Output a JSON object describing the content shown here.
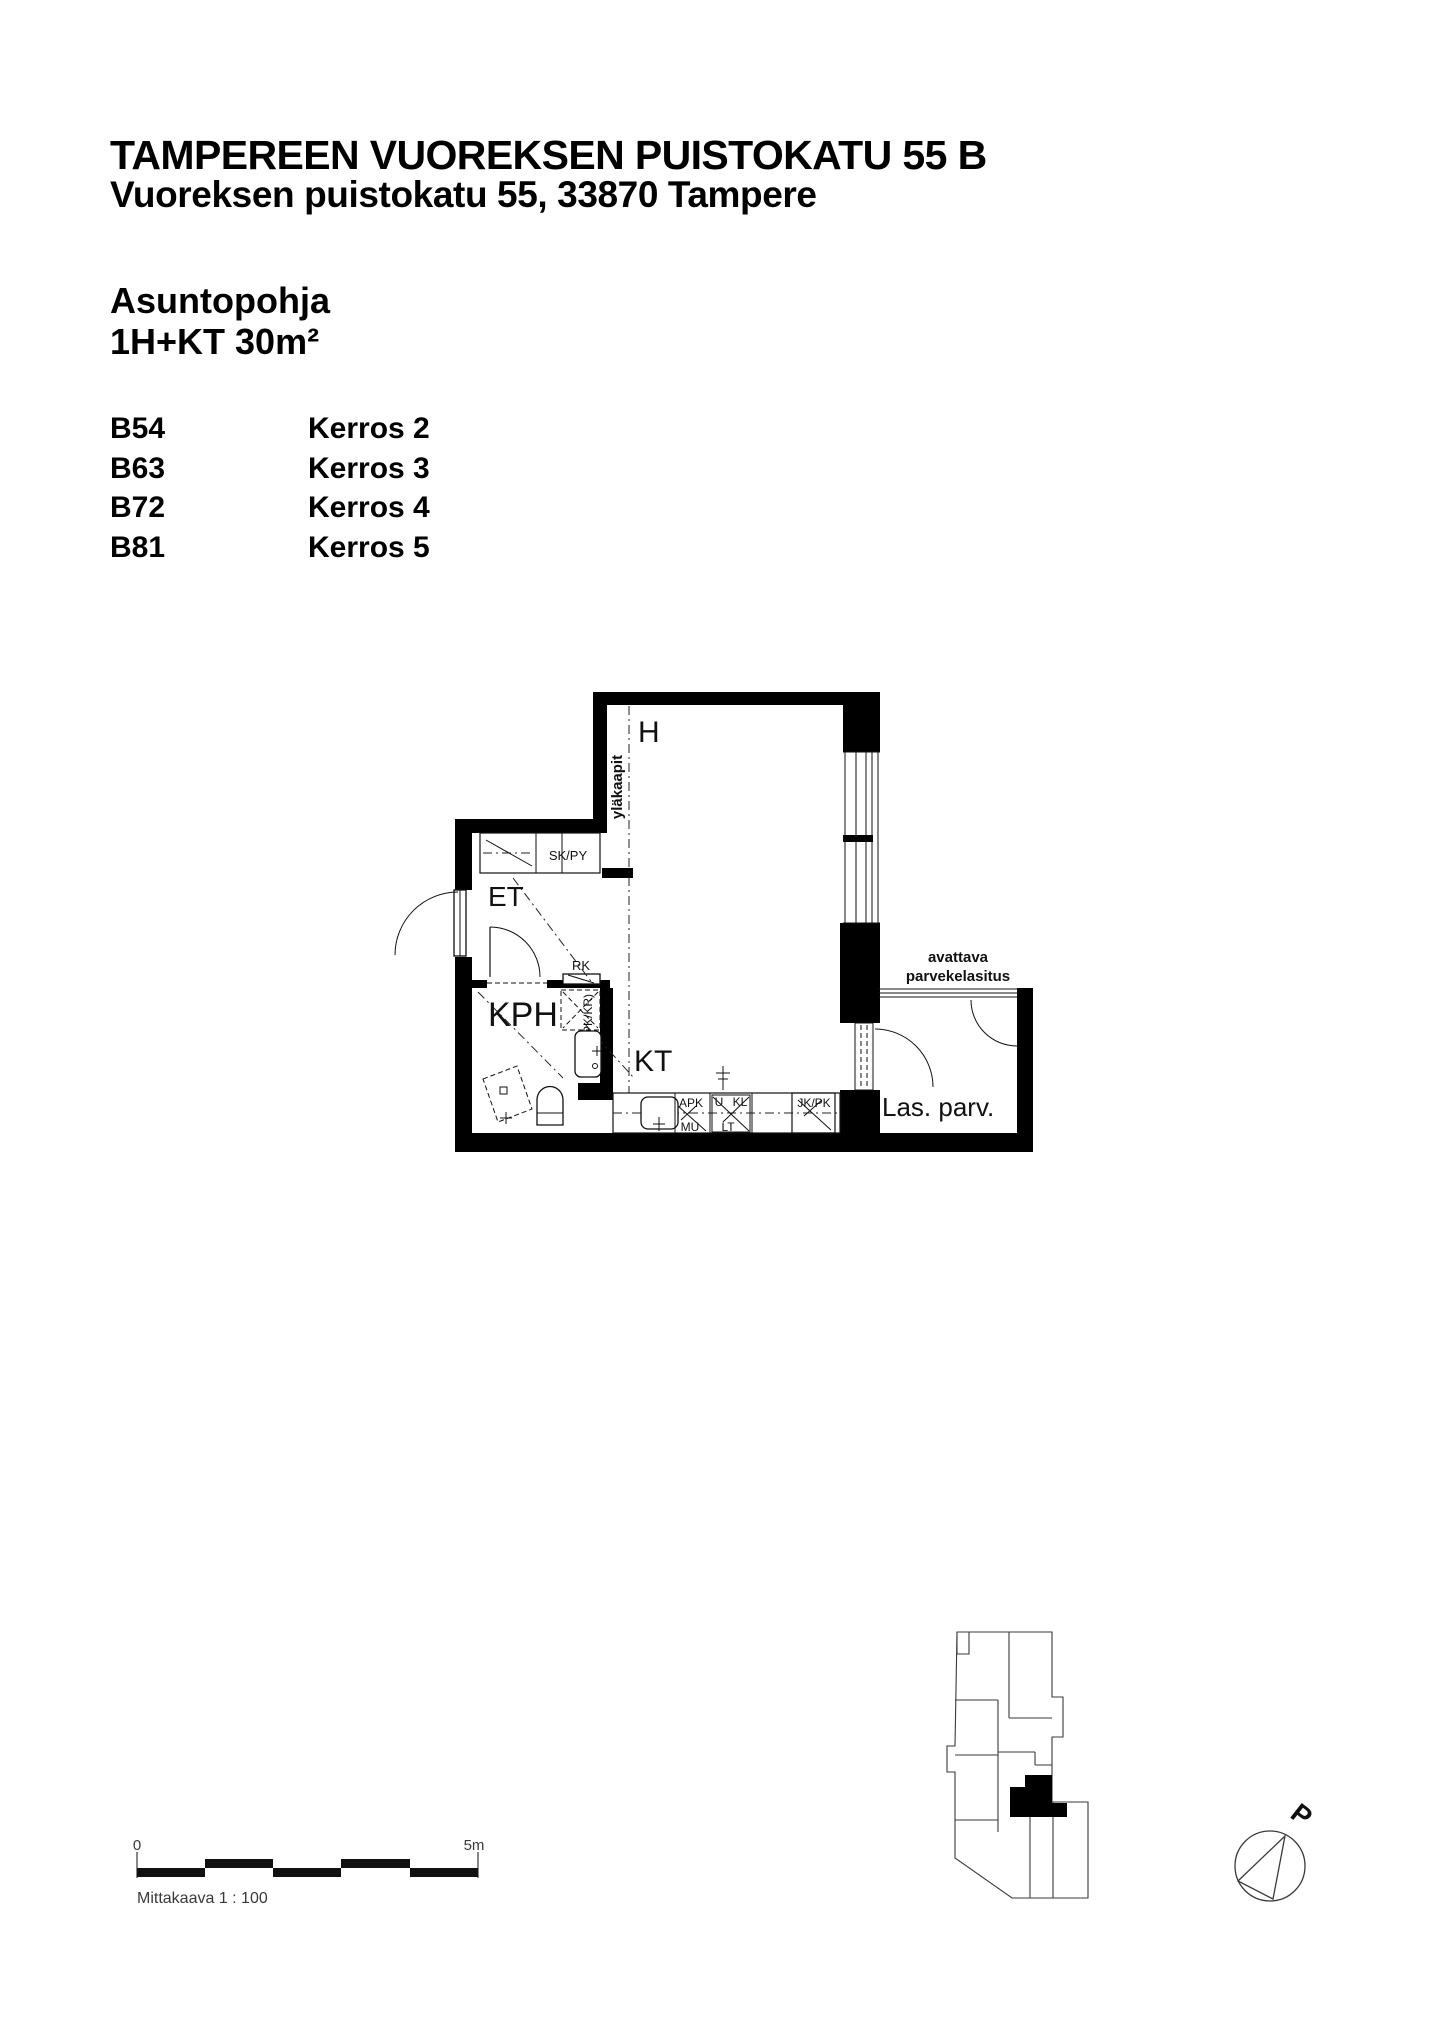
{
  "palette": {
    "ink": "#000000",
    "muted": "#3a3a3a",
    "paper": "#ffffff"
  },
  "header": {
    "title": "TAMPEREEN VUOREKSEN PUISTOKATU 55 B",
    "subtitle": "Vuoreksen puistokatu 55, 33870 Tampere",
    "section_label": "Asuntopohja",
    "apartment_type": "1H+KT 30m²"
  },
  "apartments": [
    {
      "unit": "B54",
      "floor": "Kerros 2"
    },
    {
      "unit": "B63",
      "floor": "Kerros 3"
    },
    {
      "unit": "B72",
      "floor": "Kerros 4"
    },
    {
      "unit": "B81",
      "floor": "Kerros 5"
    }
  ],
  "floorplan": {
    "room_labels": {
      "main_room": "H",
      "entry": "ET",
      "bathroom": "KPH",
      "kitchen": "KT",
      "balcony": "Las. parv."
    },
    "annotations": {
      "upper_cabinets": "yläkaapit",
      "closet": "SK/PY",
      "electrical_panel": "RK",
      "laundry_reservation": "(PPK/KR)",
      "balcony_glazing_line1": "avattava",
      "balcony_glazing_line2": "parvekelasitus",
      "dishwasher": "APK",
      "microwave": "MU",
      "oven": "U",
      "cooktop": "KL",
      "stove_counter": "LT",
      "fridge_freezer": "JK/PK"
    }
  },
  "scale_bar": {
    "zero_label": "0",
    "end_label": "5m",
    "caption": "Mittakaava 1 : 100"
  },
  "compass": {
    "north_label": "P"
  }
}
